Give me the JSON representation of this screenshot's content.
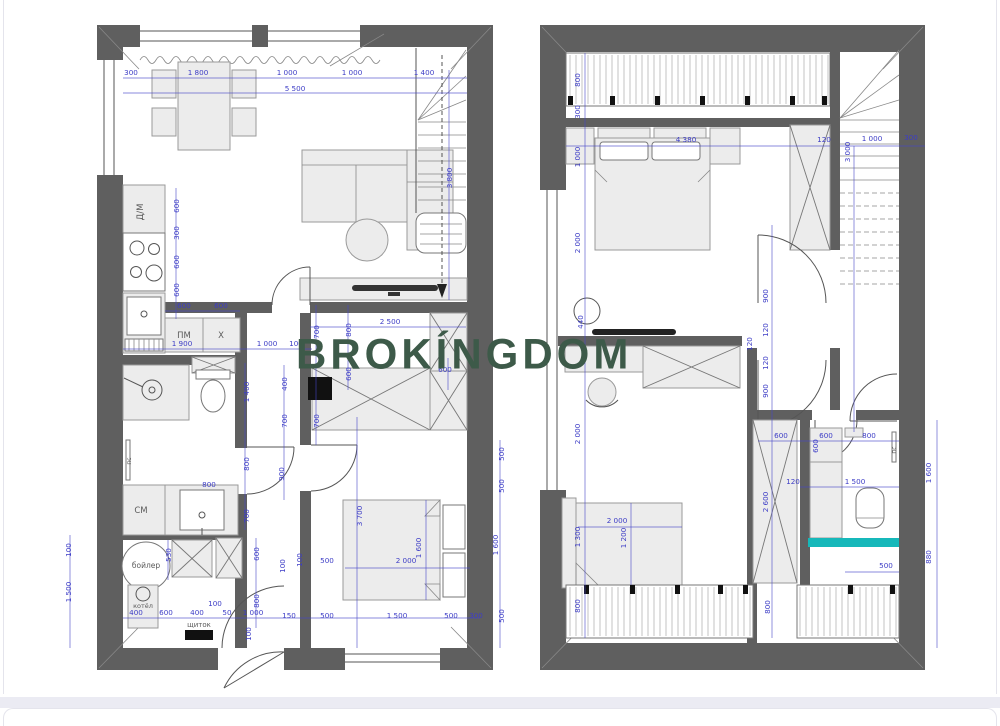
{
  "page": {
    "watermark": "BROKÍNGDOM",
    "colors": {
      "watermark_green": "#3d5a49",
      "wall_gray": "#5f5f5f",
      "dimension_blue": "#3d3dc6",
      "accent_teal": "#16b8ba",
      "background": "#ffffff",
      "gap_strip": "#ebebf3"
    }
  },
  "left_plan": {
    "rooms": [
      {
        "t": "Д/М",
        "x": 143,
        "y": 212,
        "r": -90,
        "s": 8.5
      },
      {
        "t": "ПМ",
        "x": 184,
        "y": 338,
        "s": 8.5
      },
      {
        "t": "Х",
        "x": 221,
        "y": 338,
        "s": 8.5
      },
      {
        "t": "пс",
        "x": 131,
        "y": 461,
        "r": -90,
        "s": 6
      },
      {
        "t": "СМ",
        "x": 141,
        "y": 513,
        "s": 8.5
      },
      {
        "t": "бойлер",
        "x": 146,
        "y": 568,
        "s": 7.5
      },
      {
        "t": "котёл",
        "x": 143,
        "y": 608,
        "s": 6.5
      },
      {
        "t": "щиток",
        "x": 199,
        "y": 627,
        "s": 7
      }
    ],
    "dims": [
      {
        "t": "300",
        "x": 131,
        "y": 75
      },
      {
        "t": "1 800",
        "x": 198,
        "y": 75
      },
      {
        "t": "1 000",
        "x": 287,
        "y": 75
      },
      {
        "t": "1 000",
        "x": 352,
        "y": 75
      },
      {
        "t": "1 400",
        "x": 424,
        "y": 75
      },
      {
        "t": "5 500",
        "x": 295,
        "y": 91
      },
      {
        "t": "600",
        "x": 179,
        "y": 206,
        "r": -90
      },
      {
        "t": "300",
        "x": 179,
        "y": 233,
        "r": -90
      },
      {
        "t": "600",
        "x": 179,
        "y": 262,
        "r": -90
      },
      {
        "t": "600",
        "x": 179,
        "y": 290,
        "r": -90
      },
      {
        "t": "600",
        "x": 184,
        "y": 308
      },
      {
        "t": "600",
        "x": 221,
        "y": 308
      },
      {
        "t": "1 900",
        "x": 182,
        "y": 346
      },
      {
        "t": "1 000",
        "x": 267,
        "y": 346
      },
      {
        "t": "100",
        "x": 296,
        "y": 346
      },
      {
        "t": "1 400",
        "x": 249,
        "y": 392,
        "r": -90
      },
      {
        "t": "800",
        "x": 249,
        "y": 464,
        "r": -90
      },
      {
        "t": "700",
        "x": 249,
        "y": 516,
        "r": -90
      },
      {
        "t": "800",
        "x": 209,
        "y": 487
      },
      {
        "t": "400",
        "x": 287,
        "y": 384,
        "r": -90
      },
      {
        "t": "700",
        "x": 287,
        "y": 421,
        "r": -90
      },
      {
        "t": "700",
        "x": 319,
        "y": 332,
        "r": -90
      },
      {
        "t": "700",
        "x": 319,
        "y": 421,
        "r": -90
      },
      {
        "t": "800",
        "x": 351,
        "y": 330,
        "r": -90
      },
      {
        "t": "600",
        "x": 351,
        "y": 374,
        "r": -90
      },
      {
        "t": "2 500",
        "x": 390,
        "y": 324
      },
      {
        "t": "600",
        "x": 445,
        "y": 372
      },
      {
        "t": "3 800",
        "x": 452,
        "y": 178,
        "r": -90
      },
      {
        "t": "100",
        "x": 71,
        "y": 550,
        "r": -90
      },
      {
        "t": "1 500",
        "x": 71,
        "y": 592,
        "r": -90
      },
      {
        "t": "530",
        "x": 171,
        "y": 555,
        "r": -90
      },
      {
        "t": "600",
        "x": 259,
        "y": 554,
        "r": -90
      },
      {
        "t": "800",
        "x": 259,
        "y": 601,
        "r": -90
      },
      {
        "t": "100",
        "x": 285,
        "y": 566,
        "r": -90
      },
      {
        "t": "400",
        "x": 136,
        "y": 615
      },
      {
        "t": "600",
        "x": 166,
        "y": 615
      },
      {
        "t": "400",
        "x": 197,
        "y": 615
      },
      {
        "t": "100",
        "x": 215,
        "y": 606
      },
      {
        "t": "50",
        "x": 227,
        "y": 615
      },
      {
        "t": "1 000",
        "x": 253,
        "y": 615
      },
      {
        "t": "100",
        "x": 251,
        "y": 634,
        "r": -90
      },
      {
        "t": "900",
        "x": 284,
        "y": 474,
        "r": -90
      },
      {
        "t": "100",
        "x": 302,
        "y": 560,
        "r": -90
      },
      {
        "t": "500",
        "x": 327,
        "y": 563
      },
      {
        "t": "2 000",
        "x": 406,
        "y": 563
      },
      {
        "t": "1 600",
        "x": 421,
        "y": 548,
        "r": -90
      },
      {
        "t": "3 700",
        "x": 362,
        "y": 516,
        "r": -90
      },
      {
        "t": "500",
        "x": 504,
        "y": 454,
        "r": -90
      },
      {
        "t": "500",
        "x": 504,
        "y": 486,
        "r": -90
      },
      {
        "t": "1 600",
        "x": 498,
        "y": 545,
        "r": -90
      },
      {
        "t": "500",
        "x": 504,
        "y": 616,
        "r": -90
      },
      {
        "t": "150",
        "x": 289,
        "y": 618
      },
      {
        "t": "500",
        "x": 327,
        "y": 618
      },
      {
        "t": "1 500",
        "x": 397,
        "y": 618
      },
      {
        "t": "500",
        "x": 451,
        "y": 618
      },
      {
        "t": "300",
        "x": 476,
        "y": 618
      }
    ]
  },
  "right_plan": {
    "rooms": [
      {
        "t": "пс",
        "x": 896,
        "y": 450,
        "r": -90,
        "s": 6
      }
    ],
    "dims": [
      {
        "t": "800",
        "x": 580,
        "y": 80,
        "r": -90
      },
      {
        "t": "300",
        "x": 580,
        "y": 112,
        "r": -90
      },
      {
        "t": "1 000",
        "x": 580,
        "y": 157,
        "r": -90
      },
      {
        "t": "2 000",
        "x": 580,
        "y": 243,
        "r": -90
      },
      {
        "t": "440",
        "x": 583,
        "y": 322,
        "r": -90
      },
      {
        "t": "2 000",
        "x": 580,
        "y": 434,
        "r": -90
      },
      {
        "t": "1 300",
        "x": 580,
        "y": 537,
        "r": -90
      },
      {
        "t": "800",
        "x": 580,
        "y": 606,
        "r": -90
      },
      {
        "t": "4 380",
        "x": 686,
        "y": 142
      },
      {
        "t": "120",
        "x": 824,
        "y": 142
      },
      {
        "t": "1 000",
        "x": 872,
        "y": 141
      },
      {
        "t": "300",
        "x": 911,
        "y": 140
      },
      {
        "t": "3 000",
        "x": 850,
        "y": 152,
        "r": -90
      },
      {
        "t": "900",
        "x": 768,
        "y": 296,
        "r": -90
      },
      {
        "t": "120",
        "x": 768,
        "y": 330,
        "r": -90
      },
      {
        "t": "120",
        "x": 752,
        "y": 344,
        "r": -90
      },
      {
        "t": "120",
        "x": 768,
        "y": 363,
        "r": -90
      },
      {
        "t": "900",
        "x": 768,
        "y": 391,
        "r": -90
      },
      {
        "t": "600",
        "x": 781,
        "y": 438
      },
      {
        "t": "600",
        "x": 826,
        "y": 438
      },
      {
        "t": "800",
        "x": 869,
        "y": 438
      },
      {
        "t": "600",
        "x": 818,
        "y": 446,
        "r": -90
      },
      {
        "t": "120",
        "x": 793,
        "y": 484
      },
      {
        "t": "1 500",
        "x": 855,
        "y": 484
      },
      {
        "t": "2 600",
        "x": 768,
        "y": 502,
        "r": -90
      },
      {
        "t": "2 000",
        "x": 617,
        "y": 523
      },
      {
        "t": "1 200",
        "x": 626,
        "y": 538,
        "r": -90
      },
      {
        "t": "500",
        "x": 886,
        "y": 568
      },
      {
        "t": "1 600",
        "x": 931,
        "y": 473,
        "r": -90
      },
      {
        "t": "880",
        "x": 931,
        "y": 557,
        "r": -90
      },
      {
        "t": "800",
        "x": 770,
        "y": 607,
        "r": -90
      }
    ]
  }
}
